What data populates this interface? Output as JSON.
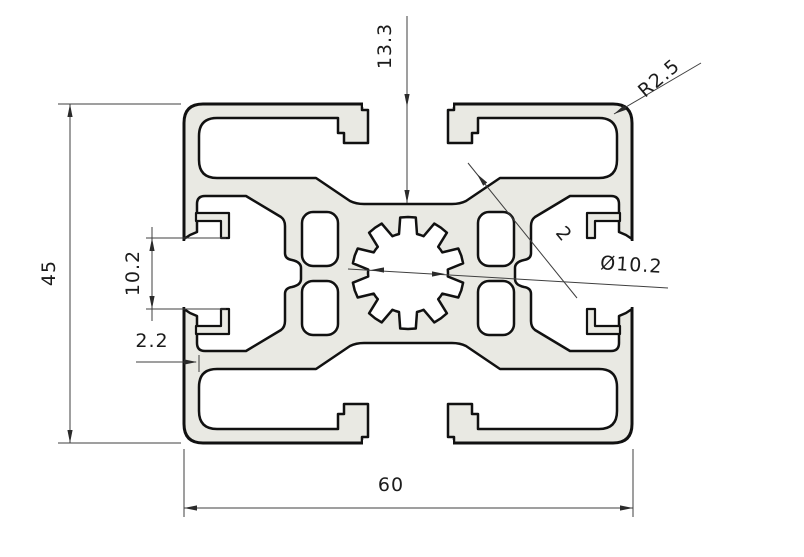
{
  "diagram": {
    "type": "technical-drawing",
    "subject": "Aluminum extrusion profile 60x45 cross-section with T-slots and center screw hole",
    "dimensions": {
      "slot_depth": "13.3",
      "corner_radius": "R2.5",
      "profile_height": "45",
      "slot_opening_width": "10.2",
      "outer_wall_thickness": "2.2",
      "inner_web_thickness": "2",
      "center_hole_diameter": "Ø10.2",
      "profile_width": "60"
    },
    "colors": {
      "material_fill": "#e9e9e3",
      "outline": "#111111",
      "dimension_lines": "#3f3f3f",
      "background": "#ffffff"
    }
  }
}
